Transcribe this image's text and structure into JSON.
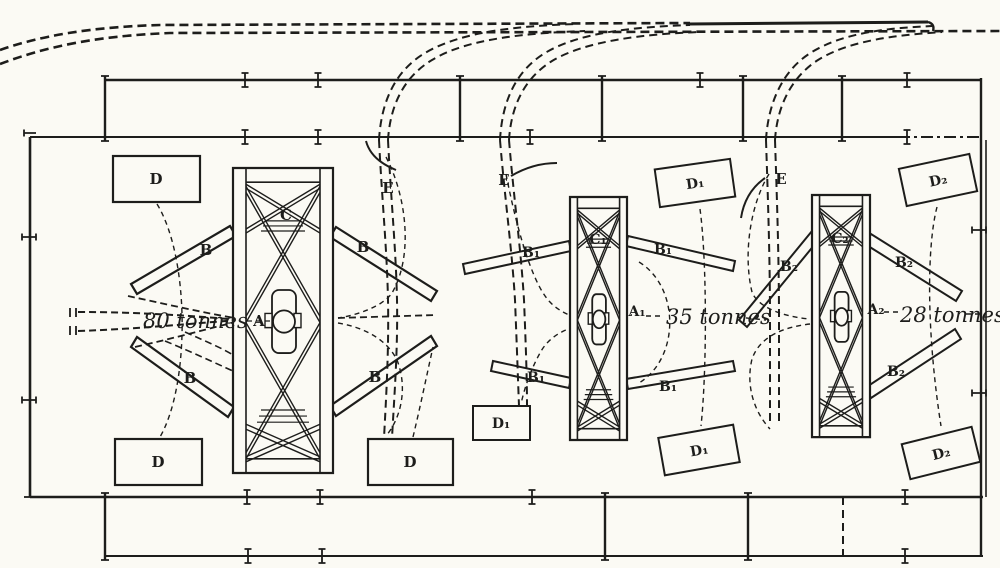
{
  "diagram": {
    "paper_color": "#fbfaf4",
    "ink_color": "#1d1d1b",
    "cranes": [
      {
        "capacity": "80 tonnes",
        "pivot_label": "A",
        "jib_label": "B",
        "frame_label": "C",
        "platform_label": "D"
      },
      {
        "capacity": "35 tonnes",
        "pivot_label": "A₁",
        "jib_label": "B₁",
        "frame_label": "C₁",
        "platform_label": "D₁"
      },
      {
        "capacity": "28 tonnes",
        "pivot_label": "A₂",
        "jib_label": "B₂",
        "frame_label": "C₂",
        "platform_label": "D₂"
      }
    ],
    "siding_label": "E"
  }
}
